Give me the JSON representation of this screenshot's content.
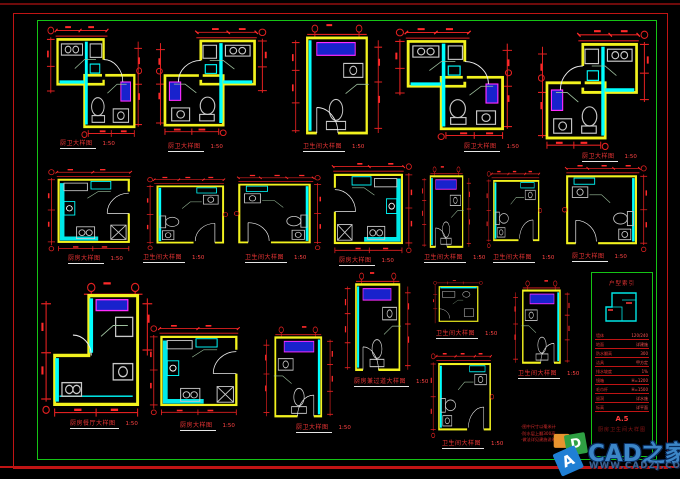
{
  "canvas": {
    "width": 680,
    "height": 479,
    "background": "#000000"
  },
  "palette": {
    "border_outer": "#c01414",
    "border_inner": "#15c415",
    "top_rule": "#6e0b0b",
    "walls": "#f2f21e",
    "fixtures_wet": "#00ffff",
    "fixtures": "#c9c9c9",
    "dimensions": "#e02020",
    "labels": "#e83434",
    "blue_box_fill": "#1822cc",
    "blue_box_stroke": "#ff2bff",
    "watermark_blue": "#3c86c8"
  },
  "watermark": {
    "brand": "CAD之家",
    "url": "WWW.CADZJ.COM",
    "logo_a": "A",
    "logo_d": "D"
  },
  "title_block": {
    "header": "户型索引",
    "rows": [
      {
        "text": "墙体",
        "num": "120/240"
      },
      {
        "text": "地面",
        "num": "详建施"
      },
      {
        "text": "防水翻高",
        "num": "300"
      },
      {
        "text": "洁具",
        "num": "甲方定"
      },
      {
        "text": "排水坡度",
        "num": "1%"
      },
      {
        "text": "镜箱",
        "num": "H=1200"
      },
      {
        "text": "毛巾杆",
        "num": "H=1500"
      },
      {
        "text": "留洞",
        "num": "详水施"
      },
      {
        "text": "标高",
        "num": "详平面"
      }
    ],
    "sheet_no": "A.5",
    "footer": "厨房卫生间大样图"
  },
  "notes": [
    "·图中尺寸以毫米计",
    "·防水层上翻300高",
    "·做法详见建施说明"
  ],
  "plans": [
    {
      "id": "p1",
      "sym": "combo",
      "flip": false,
      "x": 46,
      "y": 26,
      "w": 96,
      "h": 112,
      "label": "厨卫大样图",
      "scale": "1:50",
      "lx": 60,
      "ly": 141
    },
    {
      "id": "p2",
      "sym": "combo",
      "flip": true,
      "x": 156,
      "y": 28,
      "w": 112,
      "h": 108,
      "label": "厨卫大样图",
      "scale": "1:50",
      "lx": 168,
      "ly": 144
    },
    {
      "id": "p3",
      "sym": "tall",
      "flip": false,
      "x": 288,
      "y": 24,
      "w": 96,
      "h": 116,
      "label": "卫生间大样图",
      "scale": "1:50",
      "lx": 303,
      "ly": 144
    },
    {
      "id": "p4",
      "sym": "combo",
      "flip": false,
      "x": 394,
      "y": 28,
      "w": 118,
      "h": 112,
      "label": "厨卫大样图",
      "scale": "1:50",
      "lx": 464,
      "ly": 144
    },
    {
      "id": "p5",
      "sym": "combo",
      "flip": true,
      "x": 538,
      "y": 30,
      "w": 112,
      "h": 120,
      "label": "厨卫大样图",
      "scale": "1:50",
      "lx": 582,
      "ly": 154
    },
    {
      "id": "p6",
      "sym": "kitchen",
      "flip": false,
      "x": 46,
      "y": 168,
      "w": 90,
      "h": 84,
      "label": "厨房大样图",
      "scale": "1:50",
      "lx": 68,
      "ly": 256
    },
    {
      "id": "p7",
      "sym": "bath",
      "flip": false,
      "x": 146,
      "y": 176,
      "w": 82,
      "h": 74,
      "label": "卫生间大样图",
      "scale": "1:50",
      "lx": 143,
      "ly": 255
    },
    {
      "id": "p8",
      "sym": "bath",
      "flip": true,
      "x": 234,
      "y": 174,
      "w": 88,
      "h": 76,
      "label": "卫生间大样图",
      "scale": "1:50",
      "lx": 245,
      "ly": 255
    },
    {
      "id": "p9",
      "sym": "kitchen",
      "flip": true,
      "x": 328,
      "y": 162,
      "w": 86,
      "h": 92,
      "label": "厨房大样图",
      "scale": "1:50",
      "lx": 339,
      "ly": 258
    },
    {
      "id": "p10",
      "sym": "tall",
      "flip": false,
      "x": 420,
      "y": 166,
      "w": 52,
      "h": 86,
      "label": "卫生间大样图",
      "scale": "1:50",
      "lx": 424,
      "ly": 255
    },
    {
      "id": "p11",
      "sym": "bath",
      "flip": false,
      "x": 486,
      "y": 170,
      "w": 56,
      "h": 78,
      "label": "卫生间大样图",
      "scale": "1:50",
      "lx": 493,
      "ly": 255
    },
    {
      "id": "p12",
      "sym": "bath",
      "flip": true,
      "x": 562,
      "y": 164,
      "w": 86,
      "h": 88,
      "label": "厨卫大样图",
      "scale": "1:50",
      "lx": 572,
      "ly": 254
    },
    {
      "id": "p13",
      "sym": "l",
      "flip": false,
      "x": 40,
      "y": 282,
      "w": 122,
      "h": 136,
      "label": "厨房餐厅大样图",
      "scale": "1:50",
      "lx": 70,
      "ly": 421
    },
    {
      "id": "p14",
      "sym": "kitchen",
      "flip": false,
      "x": 148,
      "y": 324,
      "w": 96,
      "h": 92,
      "label": "厨房大样图",
      "scale": "1:50",
      "lx": 180,
      "ly": 423
    },
    {
      "id": "p15",
      "sym": "tall",
      "flip": true,
      "x": 262,
      "y": 326,
      "w": 74,
      "h": 96,
      "label": "厨卫大样图",
      "scale": "1:50",
      "lx": 296,
      "ly": 425
    },
    {
      "id": "p16",
      "sym": "tall",
      "flip": false,
      "x": 342,
      "y": 272,
      "w": 70,
      "h": 104,
      "label": "厨房兼过道大样图",
      "scale": "1:50",
      "lx": 354,
      "ly": 379
    },
    {
      "id": "p17",
      "sym": "small",
      "flip": false,
      "x": 432,
      "y": 280,
      "w": 52,
      "h": 48,
      "label": "卫生间大样图",
      "scale": "1:50",
      "lx": 436,
      "ly": 331
    },
    {
      "id": "p18",
      "sym": "bath",
      "flip": false,
      "x": 430,
      "y": 352,
      "w": 64,
      "h": 86,
      "label": "卫生间大样图",
      "scale": "1:50",
      "lx": 442,
      "ly": 441
    },
    {
      "id": "p19",
      "sym": "tall",
      "flip": true,
      "x": 512,
      "y": 280,
      "w": 60,
      "h": 88,
      "label": "卫生间大样图",
      "scale": "1:50",
      "lx": 518,
      "ly": 371
    }
  ]
}
